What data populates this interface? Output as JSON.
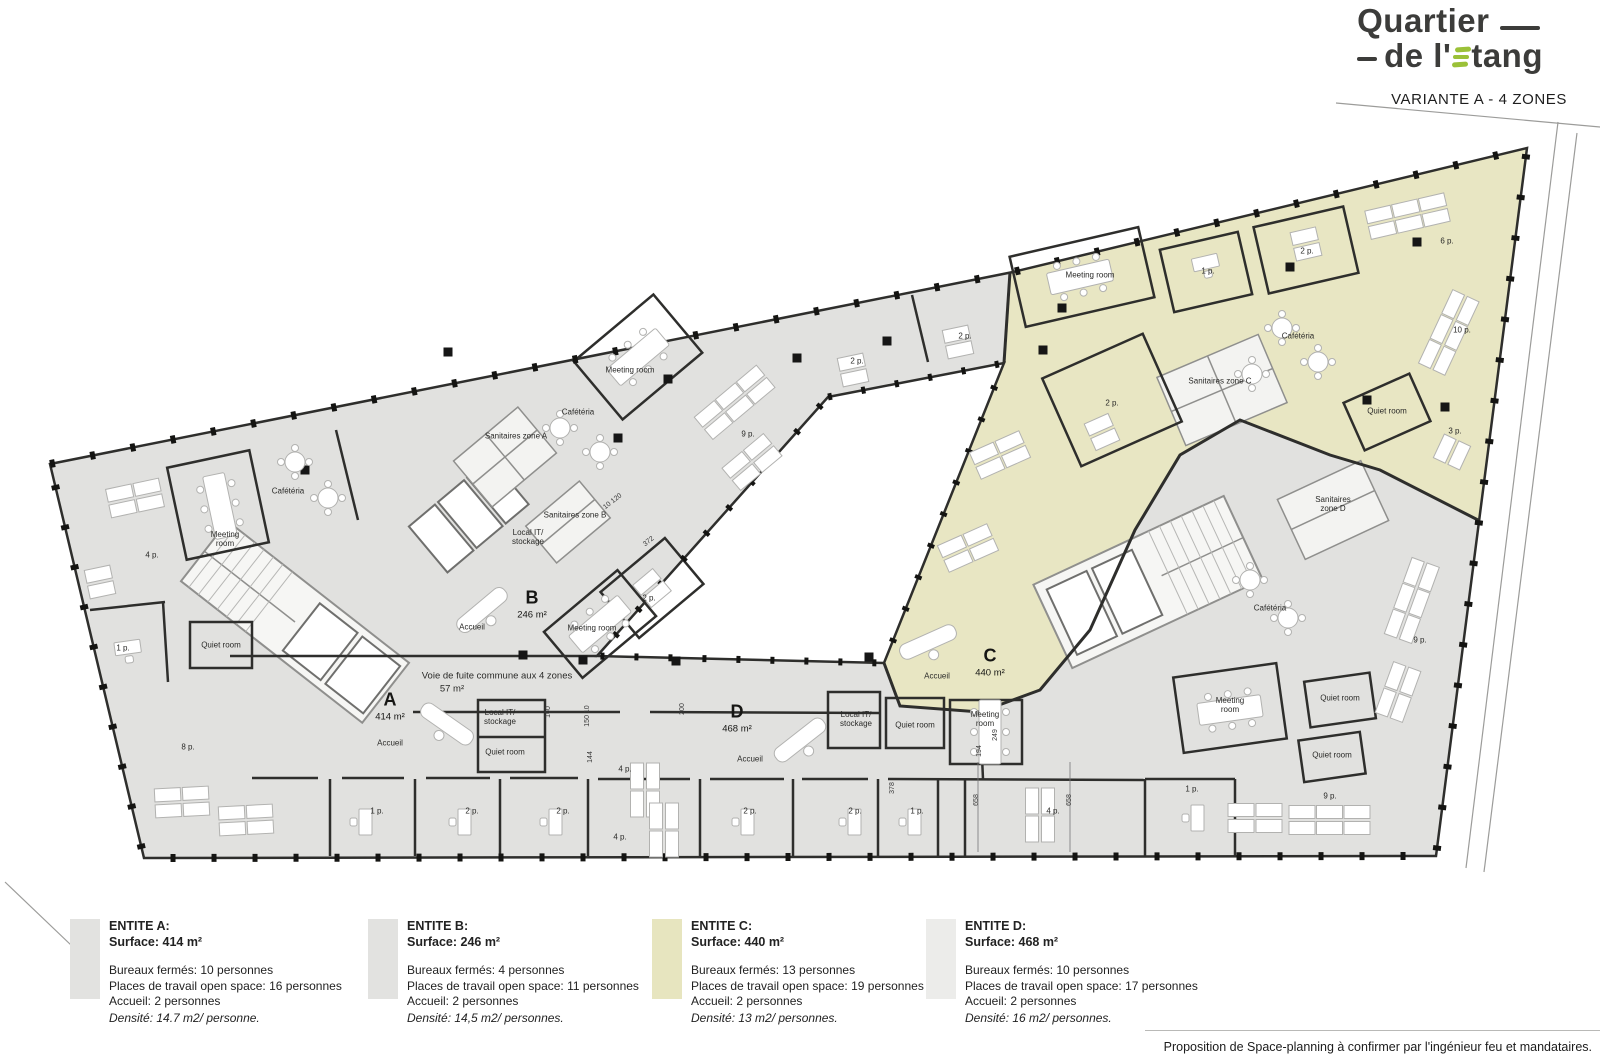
{
  "header": {
    "logo": {
      "word1": "Quartier",
      "word2_prefix": "de l'",
      "word2_suffix": "tang",
      "accent_color": "#9bc138",
      "text_color": "#3c3c3a"
    },
    "variant_title": "VARIANTE A - 4 ZONES"
  },
  "footer": {
    "note": "Proposition de Space-planning à confirmer par l'ingénieur feu et mandataires."
  },
  "legend": {
    "entities": [
      {
        "name": "ENTITE A:",
        "surface": "Surface: 414 m²",
        "color": "#e2e2e0",
        "lines": [
          "Bureaux fermés: 10 personnes",
          "Places de travail open space: 16 personnes",
          "Accueil: 2 personnes"
        ],
        "density": "Densité: 14.7 m2/ personne."
      },
      {
        "name": "ENTITE B:",
        "surface": "Surface: 246 m²",
        "color": "#e2e2e0",
        "lines": [
          "Bureaux fermés: 4 personnes",
          "Places de travail open space: 11 personnes",
          "Accueil: 2 personnes"
        ],
        "density": "Densité: 14,5 m2/ personnes."
      },
      {
        "name": "ENTITE C:",
        "surface": "Surface: 440 m²",
        "color": "#e7e5bf",
        "lines": [
          "Bureaux fermés: 13 personnes",
          "Places de travail open space: 19 personnes",
          "Accueil: 2 personnes"
        ],
        "density": "Densité: 13 m2/ personnes."
      },
      {
        "name": "ENTITE D:",
        "surface": "Surface: 468 m²",
        "color": "#ececea",
        "lines": [
          "Bureaux fermés: 10 personnes",
          "Places de travail open space: 17 personnes",
          "Accueil: 2 personnes"
        ],
        "density": "Densité: 16 m2/ personnes."
      }
    ]
  },
  "plan": {
    "colors": {
      "zone_standard": "#e1e1df",
      "zone_c": "#e8e6c3",
      "wall": "#2e2e2c",
      "courtyard": "#ffffff"
    },
    "zone_labels": [
      {
        "letter": "A",
        "area": "414 m²",
        "x": 390,
        "y": 700
      },
      {
        "letter": "B",
        "area": "246 m²",
        "x": 532,
        "y": 598
      },
      {
        "letter": "C",
        "area": "440 m²",
        "x": 990,
        "y": 656
      },
      {
        "letter": "D",
        "area": "468 m²",
        "x": 737,
        "y": 712
      }
    ],
    "room_labels": [
      {
        "text": "Cafétéria",
        "x": 288,
        "y": 492
      },
      {
        "text": "Meeting\nroom",
        "x": 225,
        "y": 540
      },
      {
        "text": "4 p.",
        "x": 152,
        "y": 556
      },
      {
        "text": "1 p.",
        "x": 123,
        "y": 649
      },
      {
        "text": "Quiet room",
        "x": 221,
        "y": 646
      },
      {
        "text": "8 p.",
        "x": 188,
        "y": 748
      },
      {
        "text": "Accueil",
        "x": 390,
        "y": 744
      },
      {
        "text": "Local IT/\nstockage",
        "x": 500,
        "y": 718
      },
      {
        "text": "Quiet room",
        "x": 505,
        "y": 753
      },
      {
        "text": "Voie de fuite commune aux 4 zones",
        "x": 497,
        "y": 677,
        "cls": "lg"
      },
      {
        "text": "57 m²",
        "x": 452,
        "y": 690,
        "cls": "lg"
      },
      {
        "text": "Accueil",
        "x": 472,
        "y": 628
      },
      {
        "text": "Meeting room",
        "x": 592,
        "y": 629
      },
      {
        "text": "2 p.",
        "x": 649,
        "y": 599
      },
      {
        "text": "Meeting room",
        "x": 630,
        "y": 371
      },
      {
        "text": "Cafétéria",
        "x": 578,
        "y": 413
      },
      {
        "text": "Sanitaires zone A",
        "x": 516,
        "y": 437
      },
      {
        "text": "Sanitaires zone B",
        "x": 575,
        "y": 516
      },
      {
        "text": "Local IT/\nstockage",
        "x": 528,
        "y": 538
      },
      {
        "text": "9 p.",
        "x": 748,
        "y": 435
      },
      {
        "text": "2 p.",
        "x": 857,
        "y": 362
      },
      {
        "text": "2 p.",
        "x": 965,
        "y": 337
      },
      {
        "text": "Meeting room",
        "x": 1090,
        "y": 276
      },
      {
        "text": "1 p.",
        "x": 1208,
        "y": 272
      },
      {
        "text": "2 p.",
        "x": 1307,
        "y": 252
      },
      {
        "text": "2 p.",
        "x": 1112,
        "y": 404
      },
      {
        "text": "Sanitaires zone C",
        "x": 1220,
        "y": 382
      },
      {
        "text": "Cafétéria",
        "x": 1298,
        "y": 337
      },
      {
        "text": "Quiet room",
        "x": 1387,
        "y": 412
      },
      {
        "text": "6 p.",
        "x": 1447,
        "y": 242
      },
      {
        "text": "10 p.",
        "x": 1462,
        "y": 331
      },
      {
        "text": "3 p.",
        "x": 1455,
        "y": 432
      },
      {
        "text": "Sanitaires\nzone D",
        "x": 1333,
        "y": 505
      },
      {
        "text": "Cafétéria",
        "x": 1270,
        "y": 609
      },
      {
        "text": "9 p.",
        "x": 1420,
        "y": 641
      },
      {
        "text": "Meeting\nroom",
        "x": 1230,
        "y": 706
      },
      {
        "text": "Quiet room",
        "x": 1340,
        "y": 699
      },
      {
        "text": "Quiet room",
        "x": 1332,
        "y": 756
      },
      {
        "text": "Accueil",
        "x": 937,
        "y": 677
      },
      {
        "text": "Accueil",
        "x": 750,
        "y": 760
      },
      {
        "text": "Local IT/\nstockage",
        "x": 856,
        "y": 720
      },
      {
        "text": "Quiet room",
        "x": 915,
        "y": 726
      },
      {
        "text": "Meeting\nroom",
        "x": 985,
        "y": 720
      },
      {
        "text": "1 p.",
        "x": 377,
        "y": 812
      },
      {
        "text": "2 p.",
        "x": 472,
        "y": 812
      },
      {
        "text": "2 p.",
        "x": 563,
        "y": 812
      },
      {
        "text": "4 p.",
        "x": 625,
        "y": 770
      },
      {
        "text": "4 p.",
        "x": 620,
        "y": 838
      },
      {
        "text": "2 p.",
        "x": 750,
        "y": 812
      },
      {
        "text": "2 p.",
        "x": 855,
        "y": 812
      },
      {
        "text": "1 p.",
        "x": 917,
        "y": 812
      },
      {
        "text": "4 p.",
        "x": 1053,
        "y": 812
      },
      {
        "text": "1 p.",
        "x": 1192,
        "y": 790
      },
      {
        "text": "9 p.",
        "x": 1330,
        "y": 797
      }
    ],
    "dim_labels": [
      {
        "text": "658",
        "x": 977,
        "y": 800,
        "rot": -90
      },
      {
        "text": "658",
        "x": 1070,
        "y": 800,
        "rot": -90
      },
      {
        "text": "150  10",
        "x": 588,
        "y": 716,
        "rot": -90
      },
      {
        "text": "144",
        "x": 591,
        "y": 757,
        "rot": -90
      },
      {
        "text": "194",
        "x": 980,
        "y": 751,
        "rot": -90
      },
      {
        "text": "249",
        "x": 996,
        "y": 735,
        "rot": -90
      },
      {
        "text": "378",
        "x": 893,
        "y": 788,
        "rot": -90
      },
      {
        "text": "372",
        "x": 649,
        "y": 542,
        "rot": -38
      },
      {
        "text": "10  120",
        "x": 613,
        "y": 502,
        "rot": -38
      },
      {
        "text": "200",
        "x": 683,
        "y": 709,
        "rot": -90
      },
      {
        "text": "160",
        "x": 549,
        "y": 712,
        "rot": -90
      }
    ]
  }
}
